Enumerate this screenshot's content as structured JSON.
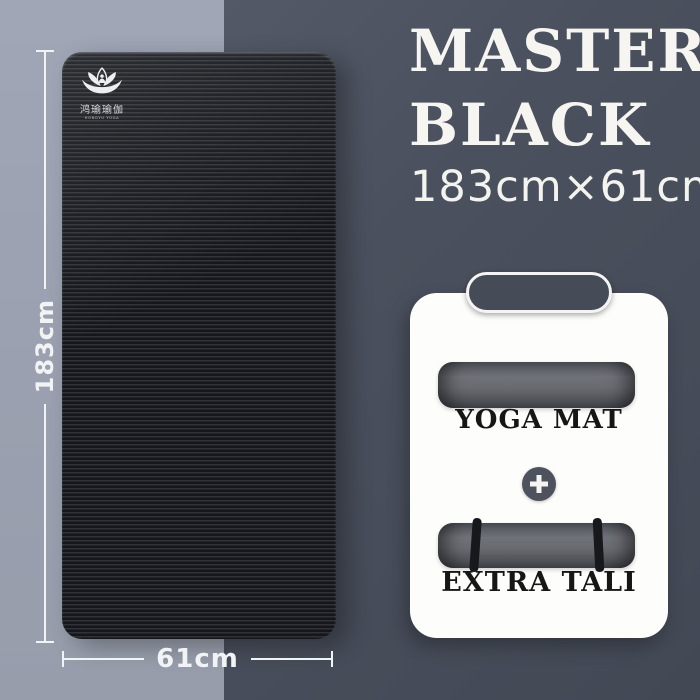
{
  "product": {
    "title_line1": "MASTER",
    "title_line2": "BLACK",
    "size_text": "183cm×61cm"
  },
  "mat": {
    "brand_text": "鸿瑜瑜伽",
    "brand_subtext": "HONGYU YOGA",
    "length_label": "183cm",
    "width_label": "61cm"
  },
  "bundle": {
    "plus": "+",
    "items": [
      {
        "label": "YOGA MAT"
      },
      {
        "label": "EXTRA TALI"
      }
    ]
  },
  "colors": {
    "bg_left": "#9aa0af",
    "bg_right": "#4a505d",
    "mat_dark": "#15171b",
    "mat_stripe": "#2e3137",
    "card_bg": "#fdfdfc",
    "handle_fill": "#454b57",
    "roll_gray": "#6f7278",
    "light_text": "#f5f5f2",
    "dark_text": "#161616"
  }
}
